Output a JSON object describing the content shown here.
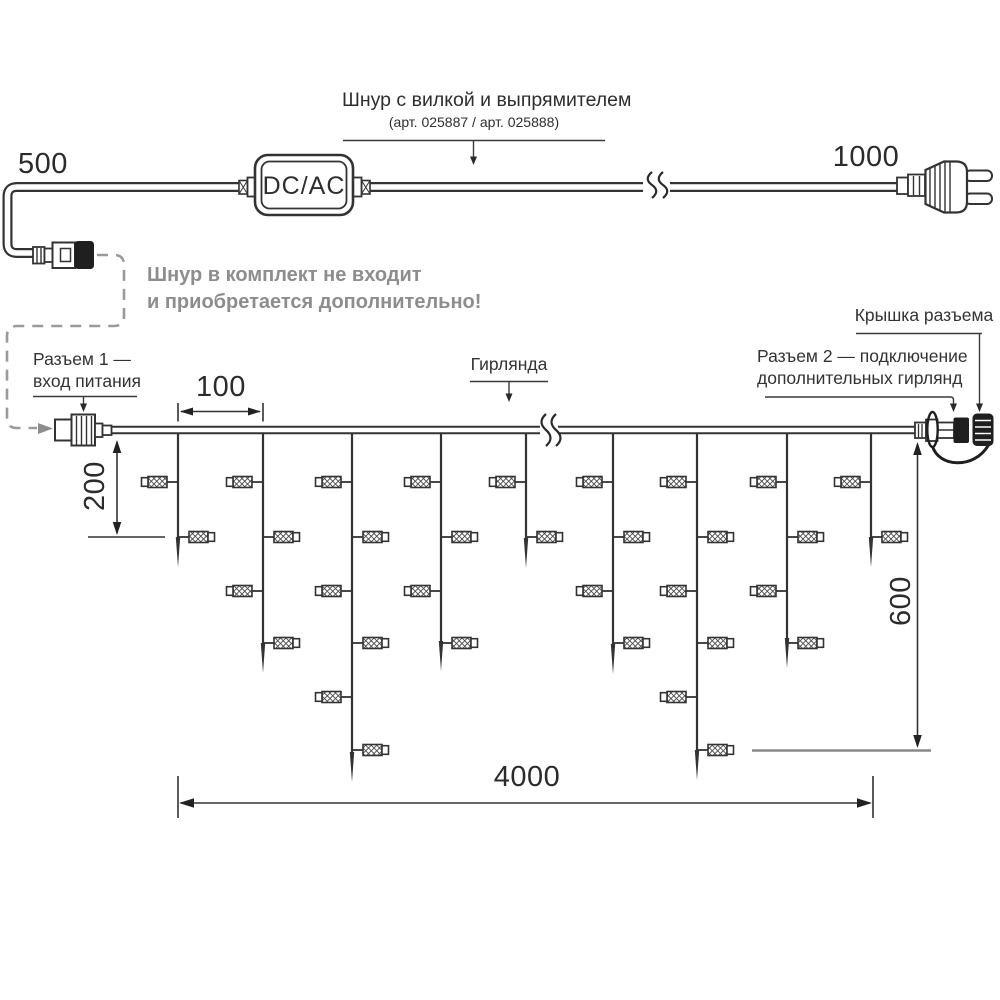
{
  "labels": {
    "dcac": "DC/AC",
    "cord_title": "Шнур с вилкой и выпрямителем",
    "cord_subtitle": "(арт. 025887 / арт. 025888)",
    "note_line1": "Шнур в комплект не входит",
    "note_line2": "и приобретается дополнительно!",
    "connector1_line1": "Разъем 1 —",
    "connector1_line2": "вход питания",
    "garland": "Гирлянда",
    "cap": "Крышка разъема",
    "connector2_line1": "Разъем 2 — подключение",
    "connector2_line2": "дополнительных гирлянд"
  },
  "dimensions": {
    "cord_left_mm": "500",
    "cord_right_mm": "1000",
    "drop_spacing_mm": "100",
    "first_drop_mm": "200",
    "max_drop_mm": "600",
    "length_mm": "4000"
  },
  "colors": {
    "line": "#333333",
    "text": "#2d2d2d",
    "note_gray": "#8d8d8d",
    "dashed_gray": "#9a9a9a",
    "ref_gray": "#888888"
  },
  "garland": {
    "line_y": 430,
    "row_y": [
      482,
      537,
      591,
      643,
      697,
      750
    ],
    "strands": [
      {
        "x": 178,
        "tip": 567,
        "lamps": [
          [
            0,
            "L"
          ],
          [
            1,
            "R"
          ]
        ]
      },
      {
        "x": 263,
        "tip": 673,
        "lamps": [
          [
            0,
            "L"
          ],
          [
            1,
            "R"
          ],
          [
            2,
            "L"
          ],
          [
            3,
            "R"
          ]
        ]
      },
      {
        "x": 352,
        "tip": 782,
        "lamps": [
          [
            0,
            "L"
          ],
          [
            1,
            "R"
          ],
          [
            2,
            "L"
          ],
          [
            3,
            "R"
          ],
          [
            4,
            "L"
          ],
          [
            5,
            "R"
          ]
        ]
      },
      {
        "x": 441,
        "tip": 671,
        "lamps": [
          [
            0,
            "L"
          ],
          [
            1,
            "R"
          ],
          [
            2,
            "L"
          ],
          [
            3,
            "R"
          ]
        ]
      },
      {
        "x": 526,
        "tip": 568,
        "lamps": [
          [
            0,
            "L"
          ],
          [
            1,
            "R"
          ]
        ]
      },
      {
        "x": 613,
        "tip": 674,
        "lamps": [
          [
            0,
            "L"
          ],
          [
            1,
            "R"
          ],
          [
            2,
            "L"
          ],
          [
            3,
            "R"
          ]
        ]
      },
      {
        "x": 697,
        "tip": 780,
        "lamps": [
          [
            0,
            "L"
          ],
          [
            1,
            "R"
          ],
          [
            2,
            "L"
          ],
          [
            3,
            "R"
          ],
          [
            4,
            "L"
          ],
          [
            5,
            "R"
          ]
        ]
      },
      {
        "x": 787,
        "tip": 668,
        "lamps": [
          [
            0,
            "L"
          ],
          [
            1,
            "R"
          ],
          [
            2,
            "L"
          ],
          [
            3,
            "R"
          ]
        ]
      },
      {
        "x": 871,
        "tip": 567,
        "lamps": [
          [
            0,
            "L"
          ],
          [
            1,
            "R"
          ]
        ]
      }
    ]
  }
}
